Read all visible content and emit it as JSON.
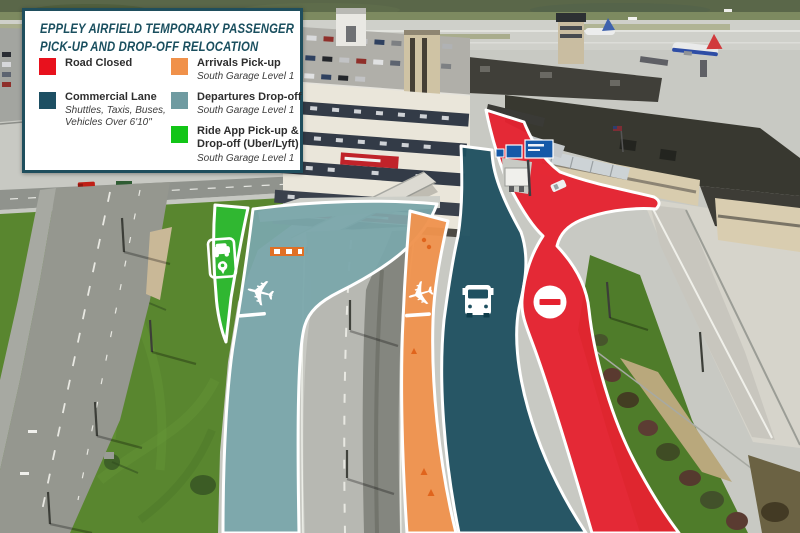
{
  "legend": {
    "title_line1": "EPPLEY AIRFIELD TEMPORARY PASSENGER",
    "title_line2": "PICK-UP AND DROP-OFF RELOCATION",
    "title_color": "#1a4f5f",
    "border_color": "#1f4e5d",
    "items": [
      {
        "label": "Road Closed",
        "sublabel": "",
        "color": "#e8111d"
      },
      {
        "label": "Commercial Lane",
        "sublabel": "Shuttles, Taxis, Buses, Vehicles Over 6'10\"",
        "color": "#1d4f63"
      },
      {
        "label": "Arrivals Pick-up",
        "sublabel": "South Garage Level 1",
        "color": "#f0914a"
      },
      {
        "label": "Departures Drop-off",
        "sublabel": "South Garage Level 1",
        "color": "#6f9ba1"
      },
      {
        "label": "Ride App Pick-up & Drop-off (Uber/Lyft)",
        "sublabel": "South Garage Level 1",
        "color": "#12c517"
      }
    ]
  },
  "map": {
    "lane_colors": {
      "road_closed": "#e52230",
      "commercial": "#1f5060",
      "arrivals": "#ef934e",
      "departures": "#7aa6ab",
      "ride_app": "#2eb932"
    },
    "icons": [
      "ride-app-phone-icon",
      "departures-plane-icon",
      "arrivals-plane-icon",
      "bus-icon",
      "no-entry-icon"
    ]
  }
}
